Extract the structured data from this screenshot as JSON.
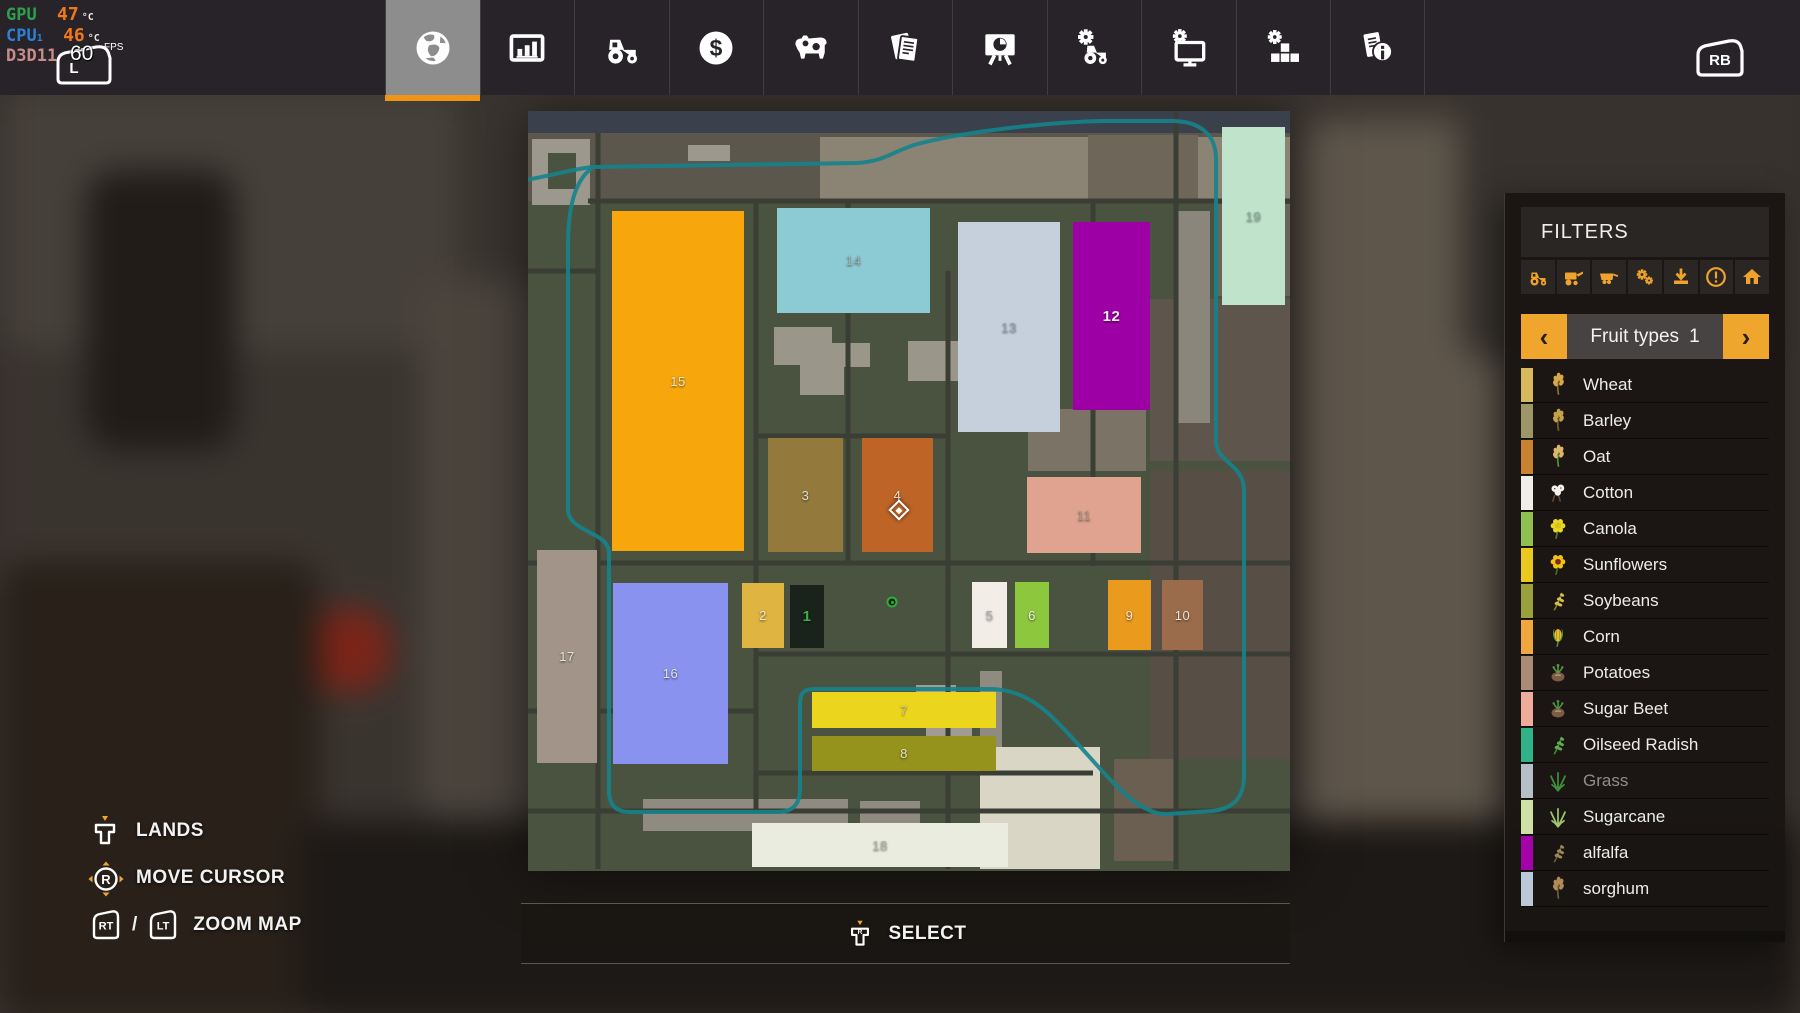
{
  "accent_color": "#f0a62c",
  "perf_overlay": {
    "gpu_label": "GPU",
    "gpu_value": "47",
    "gpu_unit": "°C",
    "cpu_label": "CPU",
    "cpu_sub": "1",
    "cpu_value": "46",
    "cpu_unit": "°C",
    "api_label": "D3D11",
    "fps_value": "60",
    "fps_unit": "FPS",
    "lb_letter": "L"
  },
  "top_bar": {
    "selected_index": 0,
    "rb_button": "RB",
    "tabs": [
      {
        "id": "map",
        "icon": "globe-icon"
      },
      {
        "id": "statistics",
        "icon": "bar-chart-icon"
      },
      {
        "id": "vehicles",
        "icon": "tractor-icon"
      },
      {
        "id": "finances",
        "icon": "dollar-icon"
      },
      {
        "id": "animals",
        "icon": "cow-icon"
      },
      {
        "id": "contracts",
        "icon": "contracts-icon"
      },
      {
        "id": "production",
        "icon": "production-board-icon"
      },
      {
        "id": "garage",
        "icon": "tractor-gear-icon"
      },
      {
        "id": "system",
        "icon": "monitor-gear-icon"
      },
      {
        "id": "mods",
        "icon": "blocks-gear-icon"
      },
      {
        "id": "help",
        "icon": "info-doc-icon"
      }
    ]
  },
  "filters_panel": {
    "title": "FILTERS",
    "filter_icons": [
      "tractor-icon",
      "harvester-icon",
      "trailer-icon",
      "gears-icon",
      "download-icon",
      "warning-icon",
      "house-icon"
    ],
    "selector": {
      "label": "Fruit types",
      "value": "1",
      "prev": "‹",
      "next": "›"
    },
    "fruit_types": [
      {
        "name": "Wheat",
        "bar_color": "#d9b95e",
        "icon_type": "ear",
        "icon_colors": [
          "#d7a94a",
          "#8a6b2c"
        ],
        "disabled": false
      },
      {
        "name": "Barley",
        "bar_color": "#9d9768",
        "icon_type": "ear",
        "icon_colors": [
          "#c5a24a",
          "#6f6030"
        ],
        "disabled": false
      },
      {
        "name": "Oat",
        "bar_color": "#c9822f",
        "icon_type": "ear",
        "icon_colors": [
          "#dbb66a",
          "#4f8f35"
        ],
        "disabled": false
      },
      {
        "name": "Cotton",
        "bar_color": "#f1eee9",
        "icon_type": "cotton",
        "icon_colors": [
          "#f3f1ec",
          "#6b4a33"
        ],
        "disabled": false
      },
      {
        "name": "Canola",
        "bar_color": "#90c051",
        "icon_type": "flower",
        "icon_colors": [
          "#e9d725",
          "#d6c31c",
          "#4a7a28"
        ],
        "disabled": false
      },
      {
        "name": "Sunflowers",
        "bar_color": "#ebc81f",
        "icon_type": "flower",
        "icon_colors": [
          "#f2c413",
          "#7a2c10",
          "#3f6d26"
        ],
        "disabled": false
      },
      {
        "name": "Soybeans",
        "bar_color": "#99a13d",
        "icon_type": "sprig",
        "icon_colors": [
          "#d8c04a",
          "#8a7a30"
        ],
        "disabled": false
      },
      {
        "name": "Corn",
        "bar_color": "#f0a73d",
        "icon_type": "corn",
        "icon_colors": [
          "#e8bc2e",
          "#4e9440"
        ],
        "disabled": false
      },
      {
        "name": "Potatoes",
        "bar_color": "#ab8b75",
        "icon_type": "root",
        "icon_colors": [
          "#7c5c42",
          "#5a9440"
        ],
        "disabled": false
      },
      {
        "name": "Sugar Beet",
        "bar_color": "#efac9c",
        "icon_type": "root",
        "icon_colors": [
          "#7c5c42",
          "#4f8f3c"
        ],
        "disabled": false
      },
      {
        "name": "Oilseed Radish",
        "bar_color": "#30b388",
        "icon_type": "sprig",
        "icon_colors": [
          "#5fae4b",
          "#3f8a38"
        ],
        "disabled": false
      },
      {
        "name": "Grass",
        "bar_color": "#b5bfc6",
        "icon_type": "blades",
        "icon_colors": [
          "#3f8f3c",
          "#2f7a2e"
        ],
        "disabled": true
      },
      {
        "name": "Sugarcane",
        "bar_color": "#d0e1a5",
        "icon_type": "blades",
        "icon_colors": [
          "#9fc66b",
          "#8ab456"
        ],
        "disabled": false
      },
      {
        "name": "alfalfa",
        "bar_color": "#a403a9",
        "icon_type": "sprig",
        "icon_colors": [
          "#9c8a52",
          "#6b5a35"
        ],
        "disabled": false
      },
      {
        "name": "sorghum",
        "bar_color": "#bac8d8",
        "icon_type": "ear",
        "icon_colors": [
          "#b08a58",
          "#6b5a3a"
        ],
        "disabled": false
      }
    ]
  },
  "map": {
    "fields": [
      {
        "id": "15",
        "x": 84,
        "y": 100,
        "w": 132,
        "h": 340,
        "color": "#f7a60b",
        "label_color": "#e8e4da",
        "bold": false
      },
      {
        "id": "14",
        "x": 249,
        "y": 97,
        "w": 153,
        "h": 105,
        "color": "#8ccad4",
        "label_color": "#9db0b5",
        "bold": false
      },
      {
        "id": "13",
        "x": 430,
        "y": 111,
        "w": 102,
        "h": 210,
        "color": "#c6d0dd",
        "label_color": "#97a1ab",
        "bold": false
      },
      {
        "id": "12",
        "x": 545,
        "y": 111,
        "w": 77,
        "h": 188,
        "color": "#9d00a4",
        "label_color": "#f2e8f2",
        "bold": true
      },
      {
        "id": "19",
        "x": 694,
        "y": 16,
        "w": 63,
        "h": 178,
        "color": "#bfe3cb",
        "label_color": "#8fae99",
        "bold": false
      },
      {
        "id": "3",
        "x": 240,
        "y": 327,
        "w": 75,
        "h": 114,
        "color": "#93793c",
        "label_color": "#e3ded2",
        "bold": false
      },
      {
        "id": "4",
        "x": 334,
        "y": 327,
        "w": 71,
        "h": 114,
        "color": "#bd6426",
        "label_color": "#eee3d6",
        "bold": false
      },
      {
        "id": "11",
        "x": 499,
        "y": 366,
        "w": 114,
        "h": 76,
        "color": "#e0a390",
        "label_color": "#a8948b",
        "bold": false
      },
      {
        "id": "17",
        "x": 9,
        "y": 439,
        "w": 60,
        "h": 213,
        "color": "#a29488",
        "label_color": "#e8e3dc",
        "bold": false
      },
      {
        "id": "16",
        "x": 85,
        "y": 472,
        "w": 115,
        "h": 181,
        "color": "#8a92f0",
        "label_color": "#dfe2f2",
        "bold": false
      },
      {
        "id": "2",
        "x": 214,
        "y": 472,
        "w": 42,
        "h": 65,
        "color": "#dfb440",
        "label_color": "#efe6d2",
        "bold": false
      },
      {
        "id": "1",
        "x": 262,
        "y": 474,
        "w": 34,
        "h": 63,
        "color": "#19231c",
        "label_color": "#3fae45",
        "bold": true
      },
      {
        "id": "5",
        "x": 444,
        "y": 471,
        "w": 35,
        "h": 66,
        "color": "#f2ede7",
        "label_color": "#b5afa8",
        "bold": false
      },
      {
        "id": "6",
        "x": 487,
        "y": 471,
        "w": 34,
        "h": 66,
        "color": "#8dc73e",
        "label_color": "#e9f0dc",
        "bold": false
      },
      {
        "id": "9",
        "x": 580,
        "y": 469,
        "w": 43,
        "h": 70,
        "color": "#ea9b1e",
        "label_color": "#f2e8d5",
        "bold": false
      },
      {
        "id": "10",
        "x": 634,
        "y": 469,
        "w": 41,
        "h": 70,
        "color": "#9a6c4c",
        "label_color": "#eee5dc",
        "bold": false
      },
      {
        "id": "7",
        "x": 284,
        "y": 581,
        "w": 184,
        "h": 36,
        "color": "#ecd51d",
        "label_color": "#cfc795",
        "bold": false
      },
      {
        "id": "8",
        "x": 284,
        "y": 625,
        "w": 184,
        "h": 35,
        "color": "#95931b",
        "label_color": "#e5e2c8",
        "bold": false
      },
      {
        "id": "18",
        "x": 224,
        "y": 712,
        "w": 256,
        "h": 44,
        "color": "#ebece0",
        "label_color": "#b4b4a6",
        "bold": false
      }
    ],
    "cursor": {
      "field": "4",
      "x": 371,
      "y": 399
    },
    "marker": {
      "x": 364,
      "y": 491
    }
  },
  "hints": {
    "lands": "LANDS",
    "move_cursor": "MOVE CURSOR",
    "zoom_map": "ZOOM MAP",
    "separator": "/",
    "select": "SELECT",
    "buttons": {
      "rt": "RT",
      "lt": "LT",
      "stick": "R",
      "select_letter": "R"
    }
  }
}
